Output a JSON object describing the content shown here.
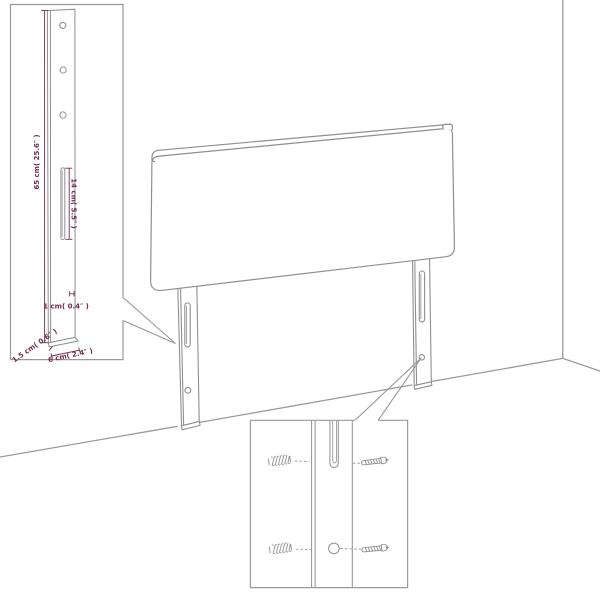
{
  "diagram": {
    "kind": "headboard-assembly-dimension-diagram",
    "dimensions": {
      "post_height": "65 cm( 25.6″ )",
      "slot_length": "14 cm( 5.5″ )",
      "hook_depth": "1 cm( 0.4″ )",
      "post_thickness": "1.5 cm( 0.6″ )",
      "post_width": "6 cm( 2.4″ )"
    },
    "colors": {
      "line_gray": "#8f8f8f",
      "box_gray": "#9a9a9a",
      "dimension_plum": "#702d4f",
      "background": "#ffffff"
    }
  }
}
